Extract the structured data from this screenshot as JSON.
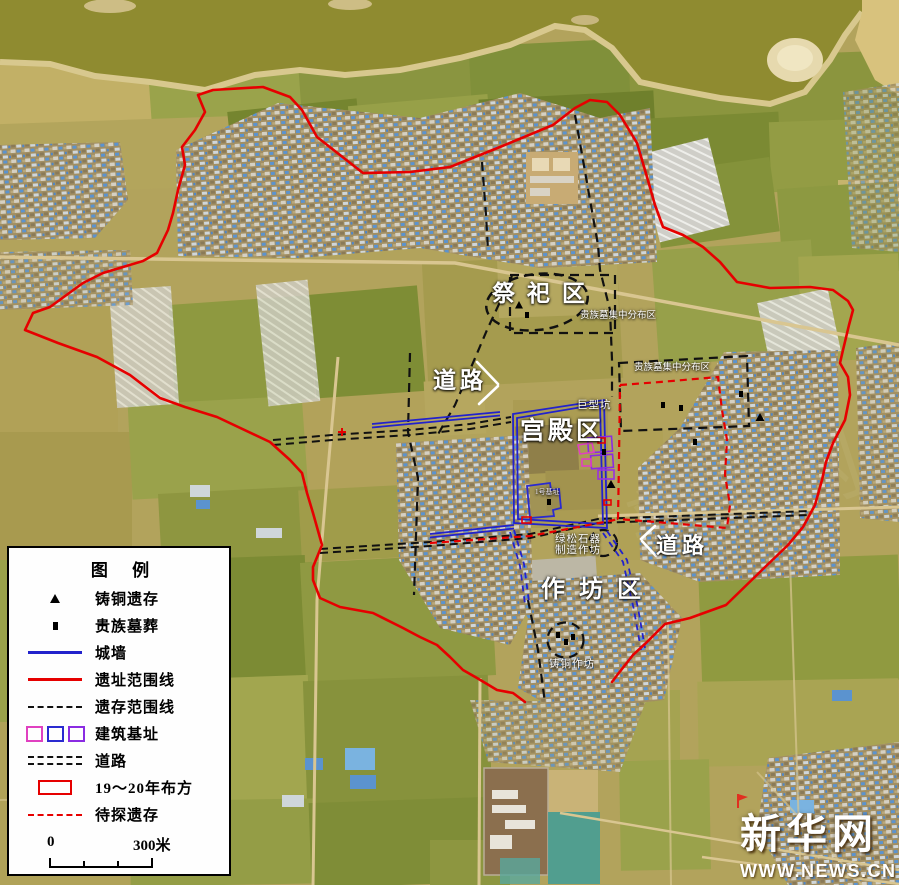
{
  "labels": {
    "sacrificial_area": "祭祀区",
    "palace_area": "宫殿区",
    "workshop_area": "作坊区",
    "road_nw": "道路",
    "road_se": "道路",
    "giant_pit": "巨型坑",
    "noble_tombs_n": "贵族墓集中分布区",
    "noble_tombs_e": "贵族墓集中分布区",
    "turquoise_line1": "绿松石器",
    "turquoise_line2": "制造作坊",
    "bronze_workshop": "铸铜作坊",
    "foundation_no1": "1号基址"
  },
  "legend": {
    "title": "图 例",
    "items": [
      {
        "symbol": "triangle-marker",
        "label": "铸铜遗存"
      },
      {
        "symbol": "square-marker",
        "label": "贵族墓葬"
      },
      {
        "symbol": "blue-solid-line",
        "label": "城墙"
      },
      {
        "symbol": "red-solid-line",
        "label": "遗址范围线"
      },
      {
        "symbol": "black-dashed-line",
        "label": "遗存范围线"
      },
      {
        "symbol": "foundation-squares",
        "label": "建筑基址"
      },
      {
        "symbol": "double-dashed-line",
        "label": "道路"
      },
      {
        "symbol": "red-rect",
        "label": "19～20年布方"
      },
      {
        "symbol": "red-dashed-line",
        "label": "待探遗存"
      }
    ],
    "scale": {
      "start": "0",
      "end": "300米"
    }
  },
  "watermark": {
    "brand": "新华网",
    "url": "WWW.NEWS.CN"
  },
  "colors": {
    "site_boundary": "#e60000",
    "city_wall": "#2222cc",
    "remains_boundary": "#111111",
    "pending_remains": "#e60000",
    "foundation_magenta": "#e040c0",
    "foundation_blue": "#2a2ad0",
    "foundation_purple": "#8a2be2"
  }
}
